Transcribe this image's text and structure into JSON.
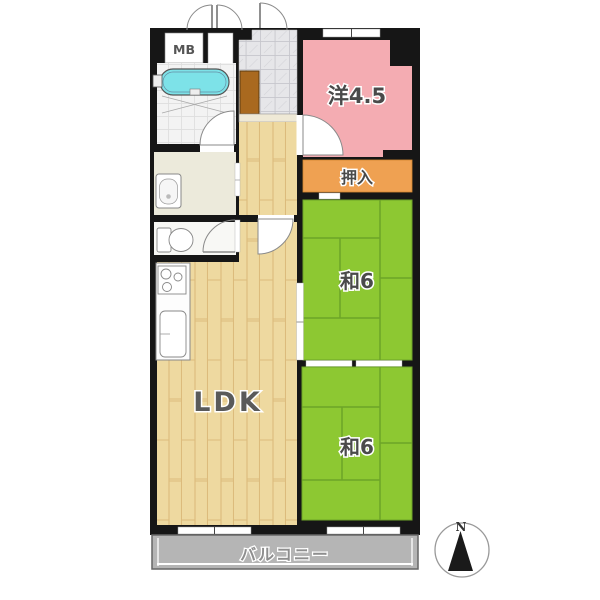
{
  "floorplan": {
    "labels": {
      "meter_box": "MB",
      "western_room": "洋4.5",
      "closet": "押入",
      "tatami_room_upper": "和6",
      "tatami_room_lower": "和6",
      "ldk": "LDK",
      "balcony": "バルコニー",
      "compass_north": "N"
    },
    "colors": {
      "wall": "#161616",
      "western_room": "#f4acb2",
      "closet": "#efa152",
      "tatami": "#8dc832",
      "tatami_line": "#6da428",
      "wood_floor": "#eed9a0",
      "wood_line": "#dcbb7c",
      "balcony": "#b5b5b5",
      "bathtub": "#7de2e8",
      "shoe_cabinet": "#a9691f",
      "genkan_tile": "#e6e6e9"
    }
  }
}
